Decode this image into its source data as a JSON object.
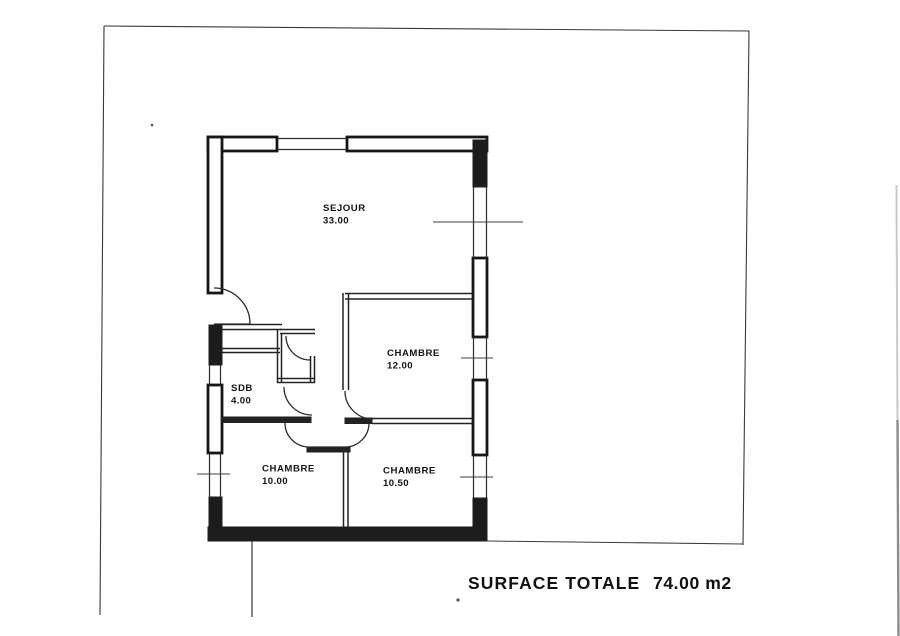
{
  "page": {
    "background": "#ffffff",
    "ink": "#1a1a1a"
  },
  "rooms": {
    "sejour": {
      "name": "SEJOUR",
      "area": "33.00"
    },
    "chambre12": {
      "name": "CHAMBRE",
      "area": "12.00"
    },
    "sdb": {
      "name": "SDB",
      "area": "4.00"
    },
    "chambre10": {
      "name": "CHAMBRE",
      "area": "10.00"
    },
    "chambre1050": {
      "name": "CHAMBRE",
      "area": "10.50"
    }
  },
  "summary": {
    "label": "SURFACE TOTALE",
    "value": "74.00 m2"
  }
}
